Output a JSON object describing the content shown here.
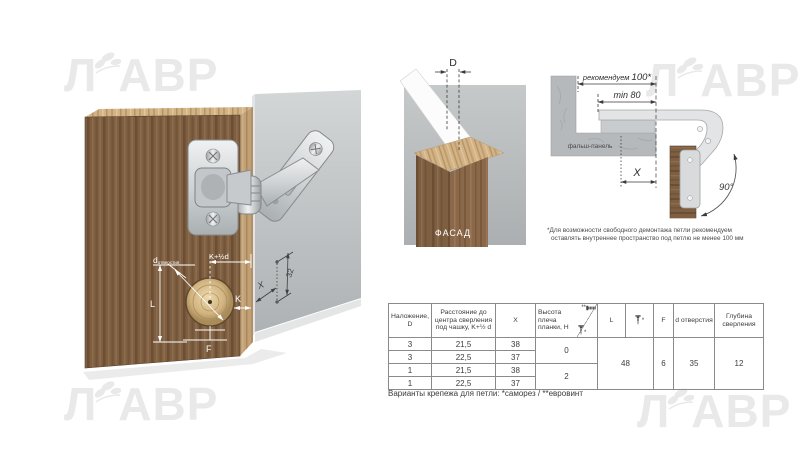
{
  "watermark": {
    "part1": "Л",
    "part2": "АВР"
  },
  "hinge_illustration": {
    "labels": {
      "hole_d": "d",
      "hole_d_sub": "отверстия",
      "k_half_d": "K+½d",
      "k": "K",
      "l": "L",
      "f": "F",
      "x": "X",
      "row_spacing": "32"
    }
  },
  "facade_diagram": {
    "dimension": "D",
    "caption": "ФАСАД"
  },
  "mounting_diagram": {
    "recommend_word": "рекомендуем ",
    "recommend_value": "100*",
    "min": "min 80",
    "panel": "фальш-панель",
    "x": "X",
    "angle": "90°",
    "note_line1": "*Для возможности свободного демонтажа петли рекомендуем",
    "note_line2": "оставлять внутреннее пространство под петлю не менее 100 мм"
  },
  "table": {
    "headers": {
      "overlay": "Наложение, D",
      "distance": "Расстояние до центра сверления под чашку, K+½ d",
      "x": "X",
      "height": "Высота плеча планки, H",
      "euro_mark": "**",
      "selftap_mark": "*",
      "l": "L",
      "screw_mark": "*",
      "f": "F",
      "hole": "d отверстия",
      "depth": "Глубина сверления"
    },
    "rows": [
      [
        "3",
        "21,5",
        "38"
      ],
      [
        "3",
        "22,5",
        "37"
      ],
      [
        "1",
        "21,5",
        "38"
      ],
      [
        "1",
        "22,5",
        "37"
      ]
    ],
    "h_group1": "0",
    "h_group2": "2",
    "l_value": "48",
    "f_value": "6",
    "hole_value": "35",
    "depth_value": "12",
    "footnote": "Варианты крепежа для петли: *саморез / **евровинт"
  },
  "colors": {
    "wood_dark": "#7e5f41",
    "wood_light": "#d2b387",
    "panel_gray": "#bfc2c4",
    "chrome": "#d6d9da"
  }
}
